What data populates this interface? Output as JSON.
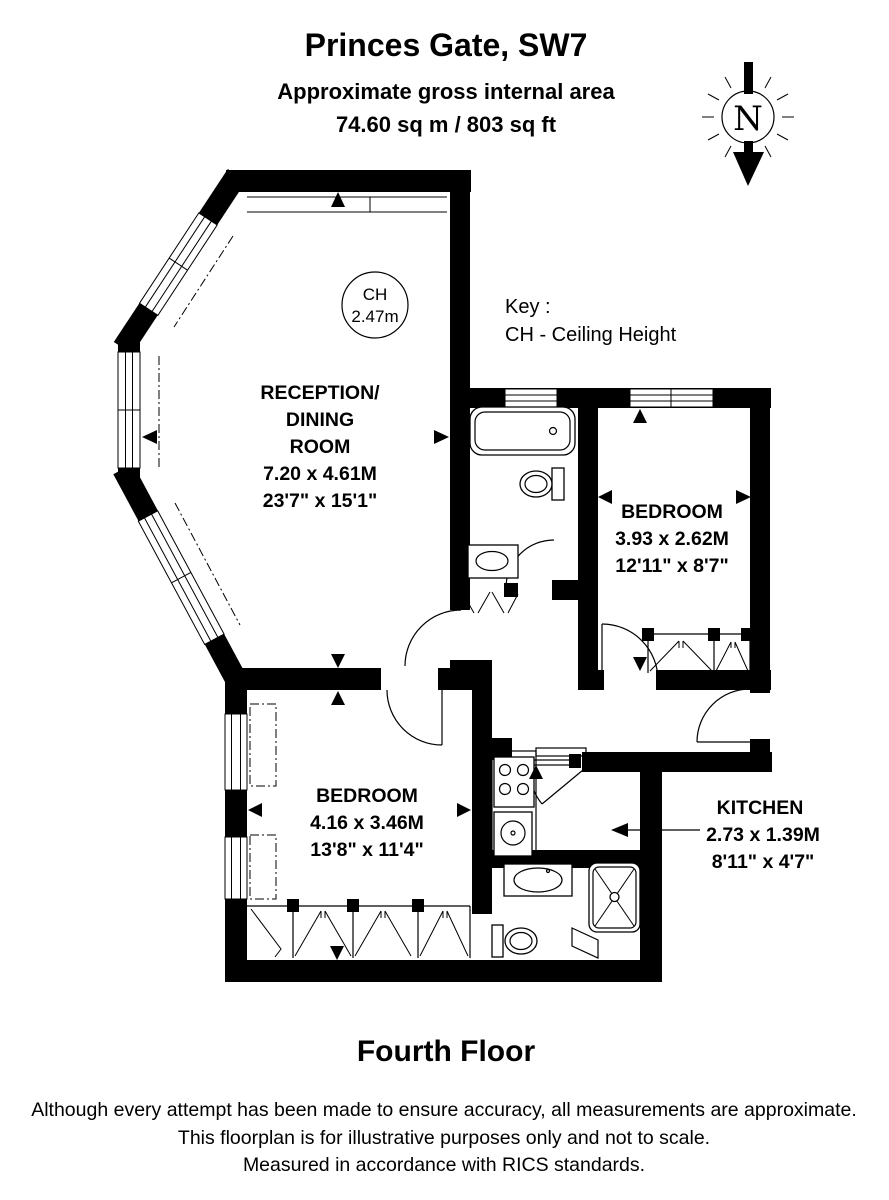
{
  "header": {
    "title": "Princes Gate, SW7",
    "subtitle": "Approximate gross internal area",
    "area": "74.60 sq m / 803 sq ft"
  },
  "compass": {
    "north_label": "N"
  },
  "ceiling_height": {
    "abbr": "CH",
    "value": "2.47m"
  },
  "key": {
    "label": "Key :",
    "entry": "CH - Ceiling Height"
  },
  "rooms": {
    "reception": {
      "name1": "RECEPTION/",
      "name2": "DINING",
      "name3": "ROOM",
      "metric": "7.20 x 4.61M",
      "imperial": "23'7\" x 15'1\""
    },
    "bedroom1": {
      "name": "BEDROOM",
      "metric": "3.93 x 2.62M",
      "imperial": "12'11\" x 8'7\""
    },
    "bedroom2": {
      "name": "BEDROOM",
      "metric": "4.16 x 3.46M",
      "imperial": "13'8\" x 11'4\""
    },
    "kitchen": {
      "name": "KITCHEN",
      "metric": "2.73 x 1.39M",
      "imperial": "8'11\" x 4'7\""
    }
  },
  "floor": {
    "label": "Fourth Floor"
  },
  "footer": {
    "line1": "Although every attempt has been made to ensure accuracy, all measurements are approximate.",
    "line2": "This floorplan is for illustrative purposes only and not to scale.",
    "line3": "Measured in accordance with RICS standards."
  }
}
